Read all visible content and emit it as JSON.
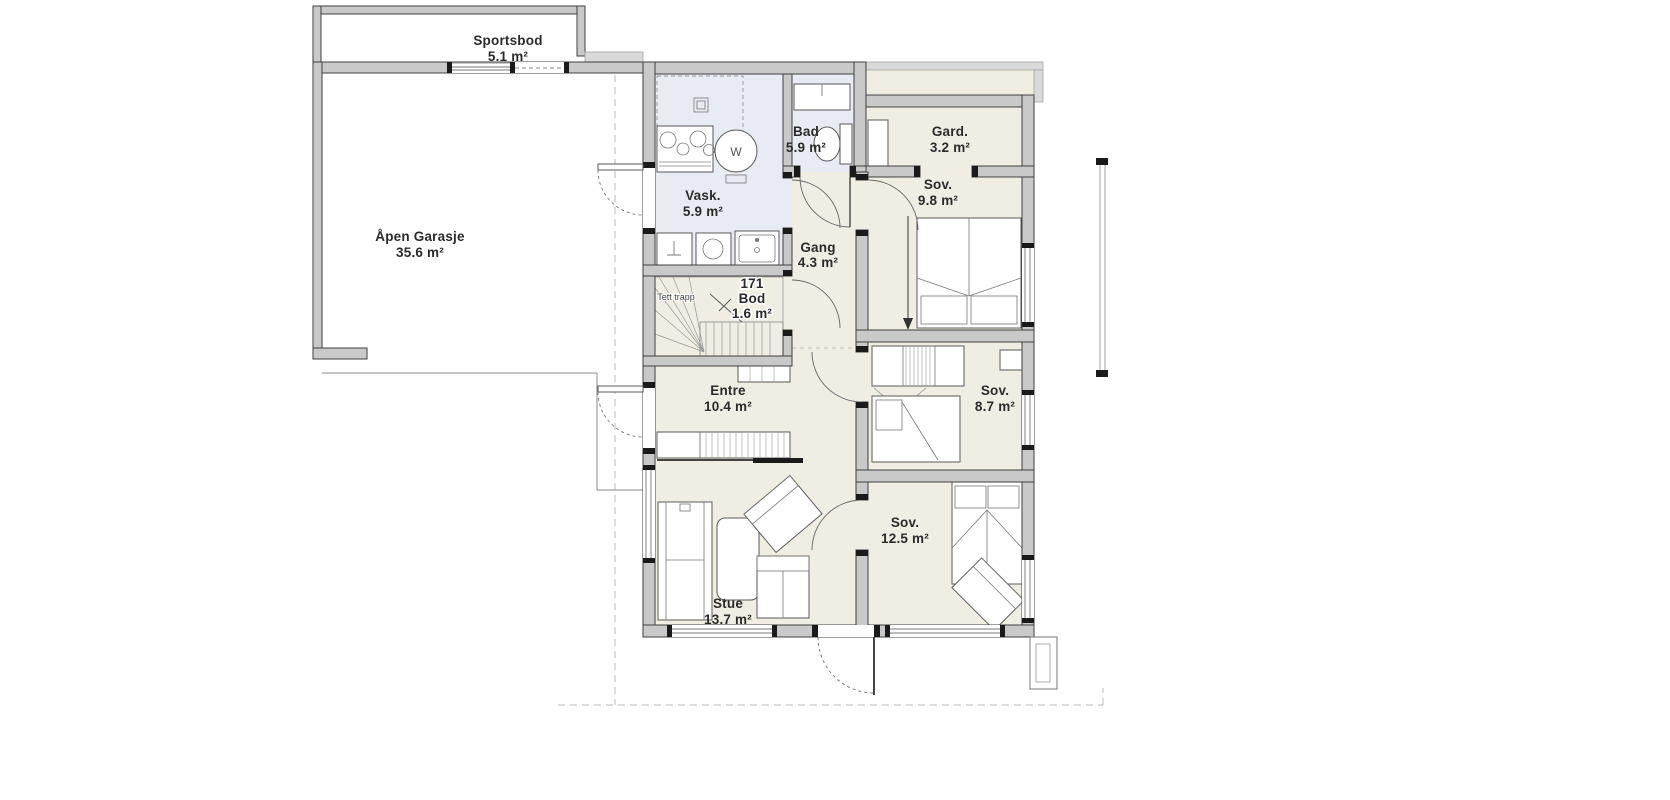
{
  "plan": {
    "rooms": {
      "sportsbod": {
        "name": "Sportsbod",
        "area": "5.1 m²"
      },
      "garasje": {
        "name": "Åpen Garasje",
        "area": "35.6 m²"
      },
      "vask": {
        "name": "Vask.",
        "area": "5.9 m²"
      },
      "bad": {
        "name": "Bad",
        "area": "5.9 m²"
      },
      "gard": {
        "name": "Gard.",
        "area": "3.2 m²"
      },
      "sov_1": {
        "name": "Sov.",
        "area": "9.8 m²"
      },
      "gang": {
        "name": "Gang",
        "area": "4.3 m²"
      },
      "bod": {
        "number": "171",
        "name": "Bod",
        "area": "1.6 m²"
      },
      "trapp": {
        "name": "Tett trapp"
      },
      "entre": {
        "name": "Entre",
        "area": "10.4 m²"
      },
      "sov_2": {
        "name": "Sov.",
        "area": "8.7 m²"
      },
      "stue": {
        "name": "Stue",
        "area": "13.7 m²"
      },
      "sov_3": {
        "name": "Sov.",
        "area": "12.5 m²"
      }
    },
    "fixtures": {
      "washer_label": "W"
    },
    "colors": {
      "room_fill": "#f0eee3",
      "wet_room_fill": "#e9ebf2",
      "wall_fill": "#c9c9c9",
      "wall_line": "#3f3f3f",
      "dashed_roof_line": "#b8b8b8"
    }
  }
}
